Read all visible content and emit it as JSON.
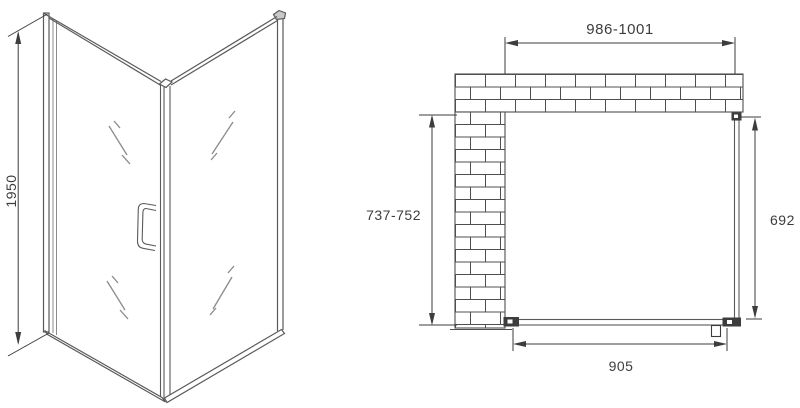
{
  "dimensions": {
    "height": "1950",
    "top_width": "986-1001",
    "left_depth": "737-752",
    "right_glass": "692",
    "bottom_door": "905"
  },
  "colors": {
    "frame_line": "#5a5a5a",
    "glass_line": "#8a8a8a",
    "dimension_line": "#3d3d3d",
    "brick_line": "#4f4f4f",
    "background": "#ffffff"
  }
}
